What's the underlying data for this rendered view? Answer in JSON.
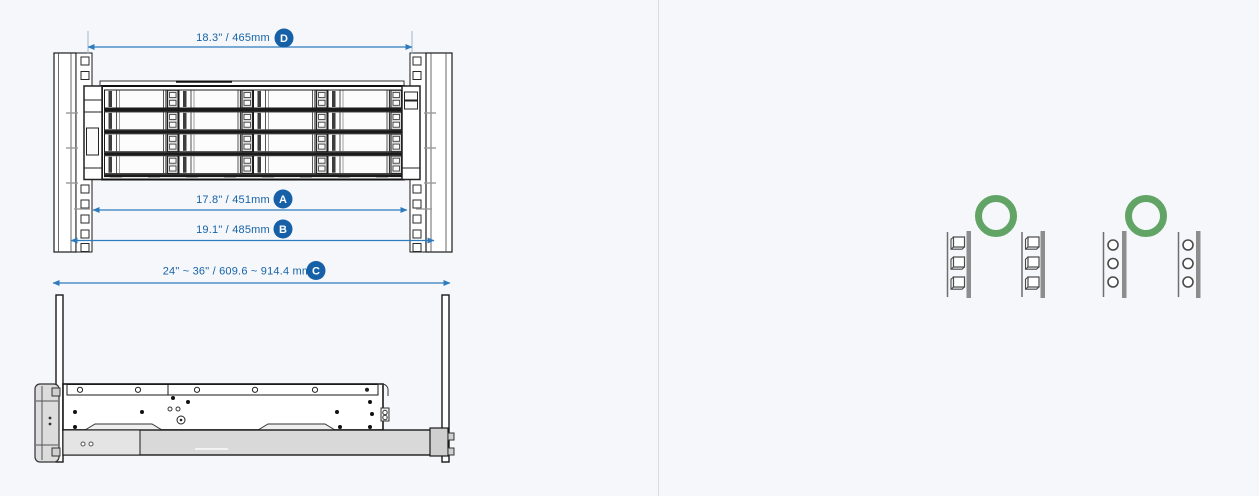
{
  "window": {
    "width": 1259,
    "height": 496,
    "background": "#f5f7fa",
    "divider_color": "#d8dbe0"
  },
  "palette": {
    "dimension_line": "#2e7bbd",
    "dimension_text": "#1763a8",
    "badge_fill": "#1560a6",
    "badge_text": "#ffffff",
    "drawing_stroke": "#1a1a1a",
    "rail_gray": "#d9d9d9",
    "compatible_green": "#61a465",
    "post_gray": "#8d8d8d"
  },
  "dimensions": {
    "d": {
      "id": "D",
      "label": "18.3\" / 465mm"
    },
    "a": {
      "id": "A",
      "label": "17.8\" / 451mm"
    },
    "b": {
      "id": "B",
      "label": "19.1\" / 485mm"
    },
    "c": {
      "id": "C",
      "label": "24\" ~ 36\" / 609.6 ~ 914.4 mm"
    }
  },
  "views": {
    "front": "rack-front-view-with-16-bay-enclosure",
    "side": "sliding-rail-side-view"
  },
  "compatibility": {
    "items": [
      {
        "name": "square-hole-rack",
        "status": "compatible",
        "icon": "compatible-ring-icon"
      },
      {
        "name": "round-hole-rack",
        "status": "compatible",
        "icon": "compatible-ring-icon"
      }
    ]
  }
}
